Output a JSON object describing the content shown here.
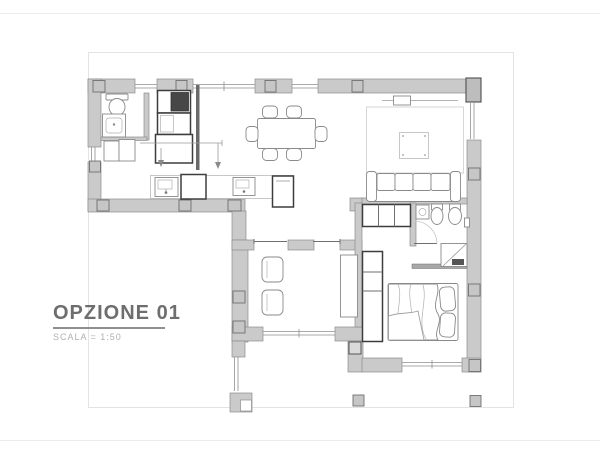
{
  "theme": {
    "wall-fill": "#cacaca",
    "wall-stroke": "#8e8e8e",
    "pillar-fill": "#c6c6c6",
    "pillar-stroke": "#6f6f6f",
    "furn-light": "#b0b0b0",
    "furn-med": "#8a8a8a",
    "furn-dark": "#3d3d3d",
    "frame-line": "#e3e3e3",
    "page-line": "#ededed",
    "title-color": "#6e6e6e",
    "subtitle-color": "#b0b0b0",
    "underline-color": "#8f8f8f"
  },
  "title_block": {
    "title": "OPZIONE 01",
    "subtitle": "SCALA = 1:50"
  },
  "drawing": {
    "type": "architectural-floor-plan",
    "rooms": [
      "bathroom",
      "entry-wardrobe",
      "kitchen",
      "dining-area",
      "living-area",
      "hallway",
      "second-bathroom",
      "study",
      "bedroom",
      "terrace"
    ]
  }
}
